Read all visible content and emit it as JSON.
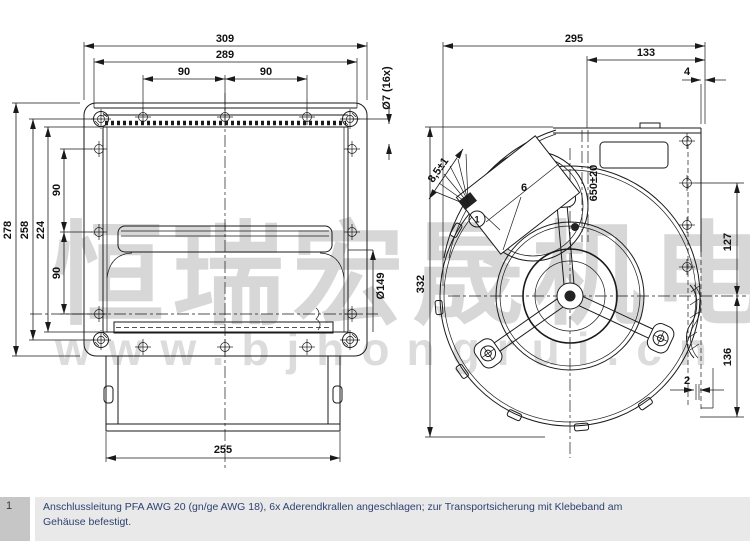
{
  "watermark": {
    "cn": "恒瑞宏晟机电",
    "url": "www.bjhongrui.cn"
  },
  "note": {
    "index": "1",
    "line1": "Anschlussleitung PFA AWG 20 (gn/ge AWG 18), 6x Aderendkrallen angeschlagen; zur Transportsicherung mit Klebeband am",
    "line2": "Gehäuse befestigt."
  },
  "front_view": {
    "dims": {
      "outer_width": "309",
      "inner_width": "289",
      "top_pitch_left": "90",
      "top_pitch_right": "90",
      "outer_height": "278",
      "inner_height": "258",
      "opening_height": "224",
      "side_pitch_upper": "90",
      "side_pitch_lower": "90",
      "base_width": "255",
      "mounting_holes": "Ø7 (16x)",
      "inlet_dia": "Ø149"
    }
  },
  "side_view": {
    "callout": "1",
    "dims": {
      "depth": "295",
      "motor_depth": "133",
      "flange_gap": "4",
      "height": "332",
      "cable_len": "650±20",
      "strip_len": "8,5±1",
      "wire_count": "6",
      "upper_offset": "127",
      "lower_offset": "136",
      "clearance": "2"
    }
  },
  "colors": {
    "line": "#1a1a1a",
    "watermark": "#d7d7d7",
    "note_text": "#2e4171",
    "note_index_bg": "#c6c6c6",
    "note_body_bg": "#e9e9e9"
  }
}
